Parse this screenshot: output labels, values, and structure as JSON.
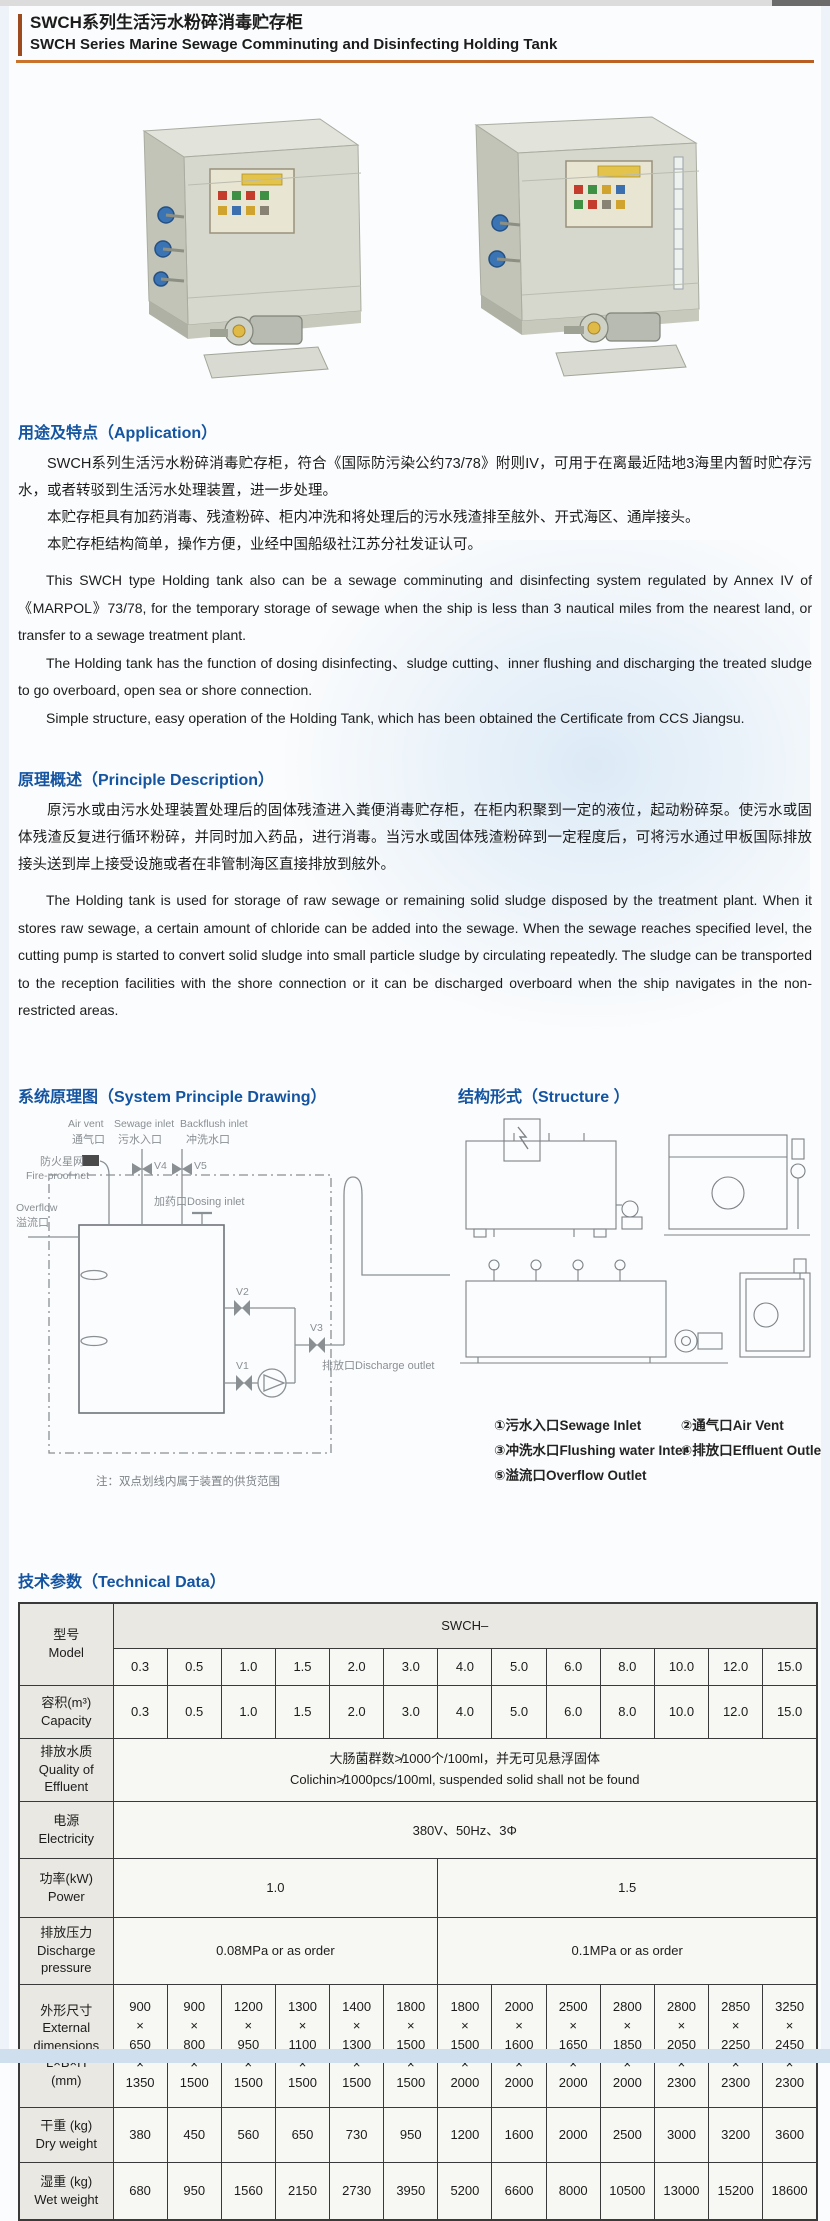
{
  "colors": {
    "accent_blue": "#1454a0",
    "accent_orange": "#c9732c"
  },
  "page": {
    "title_zh": "SWCH系列生活污水粉碎消毒贮存柜",
    "title_en": "SWCH Series Marine Sewage Comminuting and Disinfecting Holding Tank"
  },
  "application": {
    "heading": "用途及特点（Application）",
    "paragraphs_zh": [
      "SWCH系列生活污水粉碎消毒贮存柜，符合《国际防污染公约73/78》附则IV，可用于在离最近陆地3海里内暂时贮存污水，或者转驳到生活污水处理装置，进一步处理。",
      "本贮存柜具有加药消毒、残渣粉碎、柜内冲洗和将处理后的污水残渣排至舷外、开式海区、通岸接头。",
      "本贮存柜结构简单，操作方便，业经中国船级社江苏分社发证认可。"
    ],
    "paragraphs_en": [
      "This SWCH type Holding tank also can be a sewage comminuting and disinfecting system regulated by Annex IV of 《MARPOL》73/78, for the temporary storage of sewage when the ship is less than 3 nautical miles from the nearest land, or transfer to a sewage treatment plant.",
      "The Holding tank has the function of dosing disinfecting、sludge cutting、inner flushing and discharging the treated sludge to go overboard, open sea or shore connection.",
      "Simple structure, easy operation of the Holding Tank, which has been obtained the Certificate from CCS Jiangsu."
    ]
  },
  "principle": {
    "heading": "原理概述（Principle Description）",
    "paragraph_zh": "原污水或由污水处理装置处理后的固体残渣进入粪便消毒贮存柜，在柜内积聚到一定的液位，起动粉碎泵。使污水或固体残渣反复进行循环粉碎，并同时加入药品，进行消毒。当污水或固体残渣粉碎到一定程度后，可将污水通过甲板国际排放接头送到岸上接受设施或者在非管制海区直接排放到舷外。",
    "paragraph_en": "The Holding tank is used for storage of raw sewage or remaining solid sludge disposed by the treatment plant. When it stores raw sewage, a certain amount of chloride can be added into the sewage. When the sewage reaches specified level, the cutting pump is started to convert solid sludge into small particle sludge by circulating repeatedly. The sludge can be transported to the reception facilities with the shore connection or it can be discharged overboard when the ship navigates in the non-restricted areas."
  },
  "drawing": {
    "heading": "系统原理图（System Principle Drawing）",
    "labels": {
      "air_vent_en": "Air vent",
      "air_vent_zh": "通气口",
      "sewage_inlet_en": "Sewage inlet",
      "sewage_inlet_zh": "污水入口",
      "backflush_inlet_en": "Backflush inlet",
      "backflush_inlet_zh": "冲洗水口",
      "fireproof_zh": "防火星网",
      "fireproof_en": "Fire-proof net",
      "overflow_en": "Overflow",
      "overflow_zh": "溢流口",
      "dosing": "加药口Dosing inlet",
      "discharge": "排放口Discharge outlet",
      "v1": "V1",
      "v2": "V2",
      "v3": "V3",
      "v4": "V4",
      "v5": "V5",
      "note": "注：双点划线内属于装置的供货范围"
    }
  },
  "structure": {
    "heading": "结构形式（Structure ）",
    "legend": [
      {
        "num": "①",
        "zh": "污水入口",
        "en": "Sewage Inlet"
      },
      {
        "num": "②",
        "zh": "通气口",
        "en": "Air Vent"
      },
      {
        "num": "③",
        "zh": "冲洗水口",
        "en": "Flushing water Inter"
      },
      {
        "num": "④",
        "zh": "排放口",
        "en": "Effluent Outlet"
      },
      {
        "num": "⑤",
        "zh": "溢流口",
        "en": "Overflow Outlet"
      }
    ]
  },
  "technical": {
    "heading": "技术参数（Technical Data）",
    "series_header": "SWCH–",
    "row_labels": {
      "model": [
        "型号",
        "Model"
      ],
      "capacity": [
        "容积(m³)",
        "Capacity"
      ],
      "effluent": [
        "排放水质",
        "Quality of",
        "Effluent"
      ],
      "electricity": [
        "电源",
        "Electricity"
      ],
      "power": [
        "功率(kW)",
        "Power"
      ],
      "pressure": [
        "排放压力",
        "Discharge",
        "pressure"
      ],
      "dimensions": [
        "外形尺寸",
        "External",
        "dimensions",
        "L×B×H",
        "(mm)"
      ],
      "dry": [
        "干重 (kg)",
        "Dry weight"
      ],
      "wet": [
        "湿重 (kg)",
        "Wet weight"
      ]
    },
    "models": [
      "0.3",
      "0.5",
      "1.0",
      "1.5",
      "2.0",
      "3.0",
      "4.0",
      "5.0",
      "6.0",
      "8.0",
      "10.0",
      "12.0",
      "15.0"
    ],
    "capacity": [
      "0.3",
      "0.5",
      "1.0",
      "1.5",
      "2.0",
      "3.0",
      "4.0",
      "5.0",
      "6.0",
      "8.0",
      "10.0",
      "12.0",
      "15.0"
    ],
    "effluent_zh": "大肠菌群数≯1000个/100ml，并无可见悬浮固体",
    "effluent_en": "Colichin≯1000pcs/100ml, suspended solid shall not be found",
    "electricity": "380V、50Hz、3Φ",
    "power": [
      "1.0",
      "1.5"
    ],
    "pressure": [
      "0.08MPa or as order",
      "0.1MPa or as order"
    ],
    "dimensions": [
      [
        "900",
        "650",
        "1350"
      ],
      [
        "900",
        "800",
        "1500"
      ],
      [
        "1200",
        "950",
        "1500"
      ],
      [
        "1300",
        "1100",
        "1500"
      ],
      [
        "1400",
        "1300",
        "1500"
      ],
      [
        "1800",
        "1500",
        "1500"
      ],
      [
        "1800",
        "1500",
        "2000"
      ],
      [
        "2000",
        "1600",
        "2000"
      ],
      [
        "2500",
        "1650",
        "2000"
      ],
      [
        "2800",
        "1850",
        "2000"
      ],
      [
        "2800",
        "2050",
        "2300"
      ],
      [
        "2850",
        "2250",
        "2300"
      ],
      [
        "3250",
        "2450",
        "2300"
      ]
    ],
    "dry_weight": [
      "380",
      "450",
      "560",
      "650",
      "730",
      "950",
      "1200",
      "1600",
      "2000",
      "2500",
      "3000",
      "3200",
      "3600"
    ],
    "wet_weight": [
      "680",
      "950",
      "1560",
      "2150",
      "2730",
      "3950",
      "5200",
      "6600",
      "8000",
      "10500",
      "13000",
      "15200",
      "18600"
    ]
  }
}
